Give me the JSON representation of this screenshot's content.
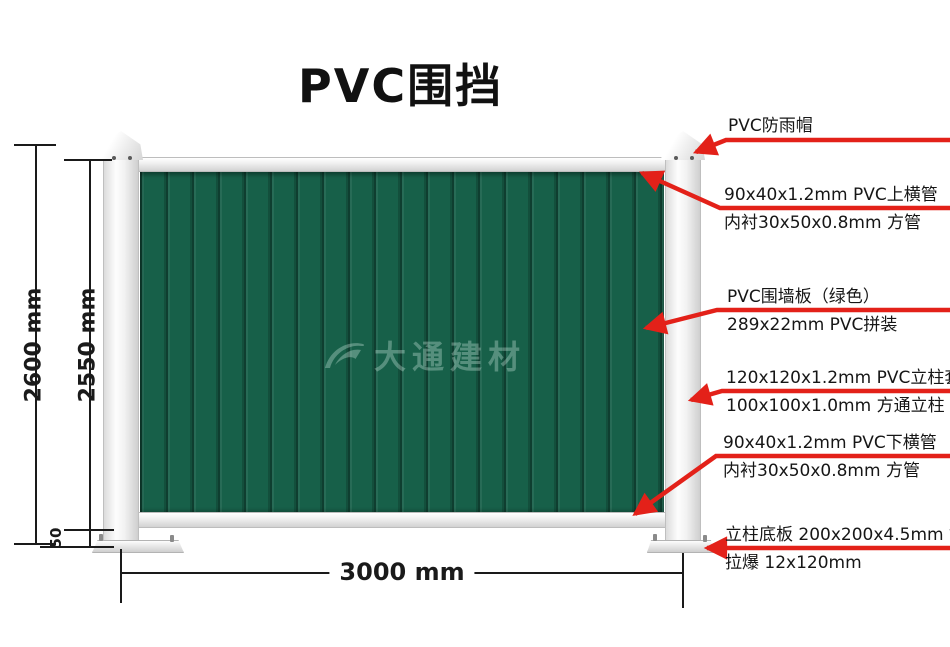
{
  "title": "PVC围挡",
  "watermark": {
    "logo": "datong-swoosh",
    "text": "大通建材"
  },
  "dimensions": {
    "total_height": "2600 mm",
    "panel_height": "2550 mm",
    "base_height": "50",
    "width": "3000 mm"
  },
  "annotations": [
    {
      "id": "rain-cap",
      "lines": [
        "PVC防雨帽",
        ""
      ]
    },
    {
      "id": "top-rail",
      "lines": [
        "90x40x1.2mm PVC上横管",
        "内衬30x50x0.8mm 方管"
      ]
    },
    {
      "id": "wall-panel",
      "lines": [
        "PVC围墙板（绿色）",
        "289x22mm PVC拼装"
      ]
    },
    {
      "id": "post-sleeve",
      "lines": [
        "120x120x1.2mm PVC立柱套",
        "100x100x1.0mm 方通立柱"
      ]
    },
    {
      "id": "bottom-rail",
      "lines": [
        "90x40x1.2mm PVC下横管",
        "内衬30x50x0.8mm 方管"
      ]
    },
    {
      "id": "base-plate",
      "lines": [
        "立柱底板 200x200x4.5mm 钢板",
        "拉爆 12x120mm"
      ]
    }
  ],
  "colors": {
    "panel_green": "#176049",
    "seam_green": "#0c4233",
    "leader_red": "#e32119",
    "line_black": "#1a1a1a"
  }
}
